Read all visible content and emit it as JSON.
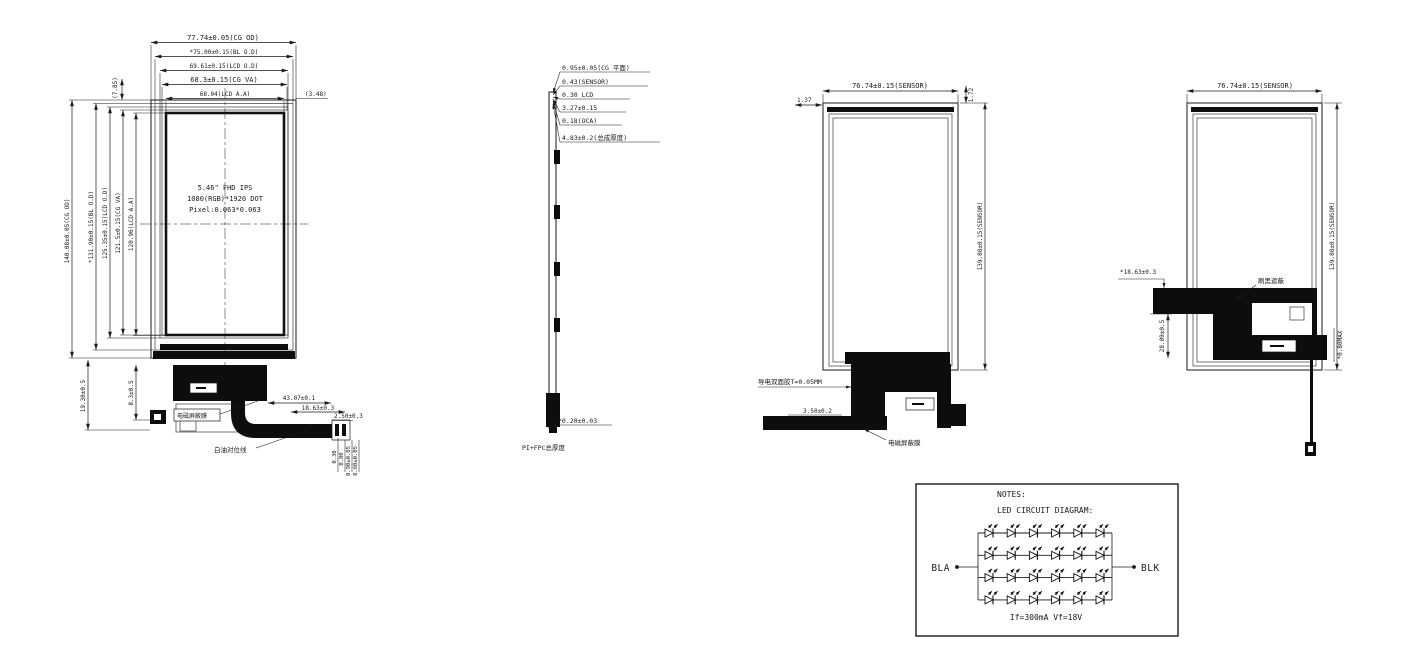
{
  "front_view": {
    "h_dims": [
      "77.74±0.05(CG OD)",
      "*75.00±0.15(BL O.D)",
      "69.61±0.15(LCD O.D)",
      "68.3±0.15(CG VA)",
      "68.04(LCD A.A)"
    ],
    "note_left": "(7.85)",
    "note_right": "(3.48)",
    "v_dims": [
      "140.08±0.05(CG OD)",
      "*131.90±0.15(BL O.D)",
      "125.35±0.15(LCD O.D)",
      "121.5±0.15(CG VA)",
      "120.96(LCD A.A)"
    ],
    "center_text": {
      "line1": "5.46\" FHD IPS",
      "line2": "1080(RGB)*1920 DOT",
      "line3": "Pixel:0.063*0.063"
    },
    "labels": {
      "shield_film": "电磁屏蔽膜",
      "white_oil_mark": "白油对位线"
    },
    "bottom_dims": {
      "width_fpc": "43.07±0.1",
      "width_tail": "18.63±0.3",
      "tail_end": "2.50±0.3",
      "left_height": "19.30±0.5",
      "inner_height": "8.3±0.5",
      "t1": "0.30",
      "t2": "0.80",
      "t3": "0.90±0.05",
      "t4": "8.60±0.05"
    }
  },
  "side_view": {
    "stack": [
      "0.95±0.05(CG 平面)",
      "0.43(SENSOR)",
      "0.30 LCD",
      "3.27±0.15",
      "0.18(OCA)",
      "4.83±0.2(总成厚度)"
    ],
    "bottom_dim": "*0.20±0.03",
    "bottom_label": "PI+FPC总厚度"
  },
  "back_view_1": {
    "top_dim": "76.74±0.15(SENSOR)",
    "corner_dim_left": "1.37",
    "corner_dim_right": "1.72",
    "right_dim": "139.08±0.15(SENSOR)",
    "tape_label": "导电双面胶T=0.05MM",
    "tail_dim": "3.50±0.2",
    "shield_label": "电磁屏蔽膜"
  },
  "back_view_2": {
    "top_dim": "76.74±0.15(SENSOR)",
    "right_dim": "139.08±0.15(SENSOR)",
    "fpc_dim": "*18.63±0.3",
    "v_dim": "28.09±0.5",
    "black_label": "刷黑遮蔽",
    "max_dim": "*0.80MAX"
  },
  "notes_box": {
    "title": "NOTES:",
    "subtitle": "LED CIRCUIT DIAGRAM:",
    "anode": "BLA",
    "cathode": "BLK",
    "spec": "If=300mA Vf=18V",
    "led_grid": {
      "rows": 4,
      "cols": 6
    }
  }
}
